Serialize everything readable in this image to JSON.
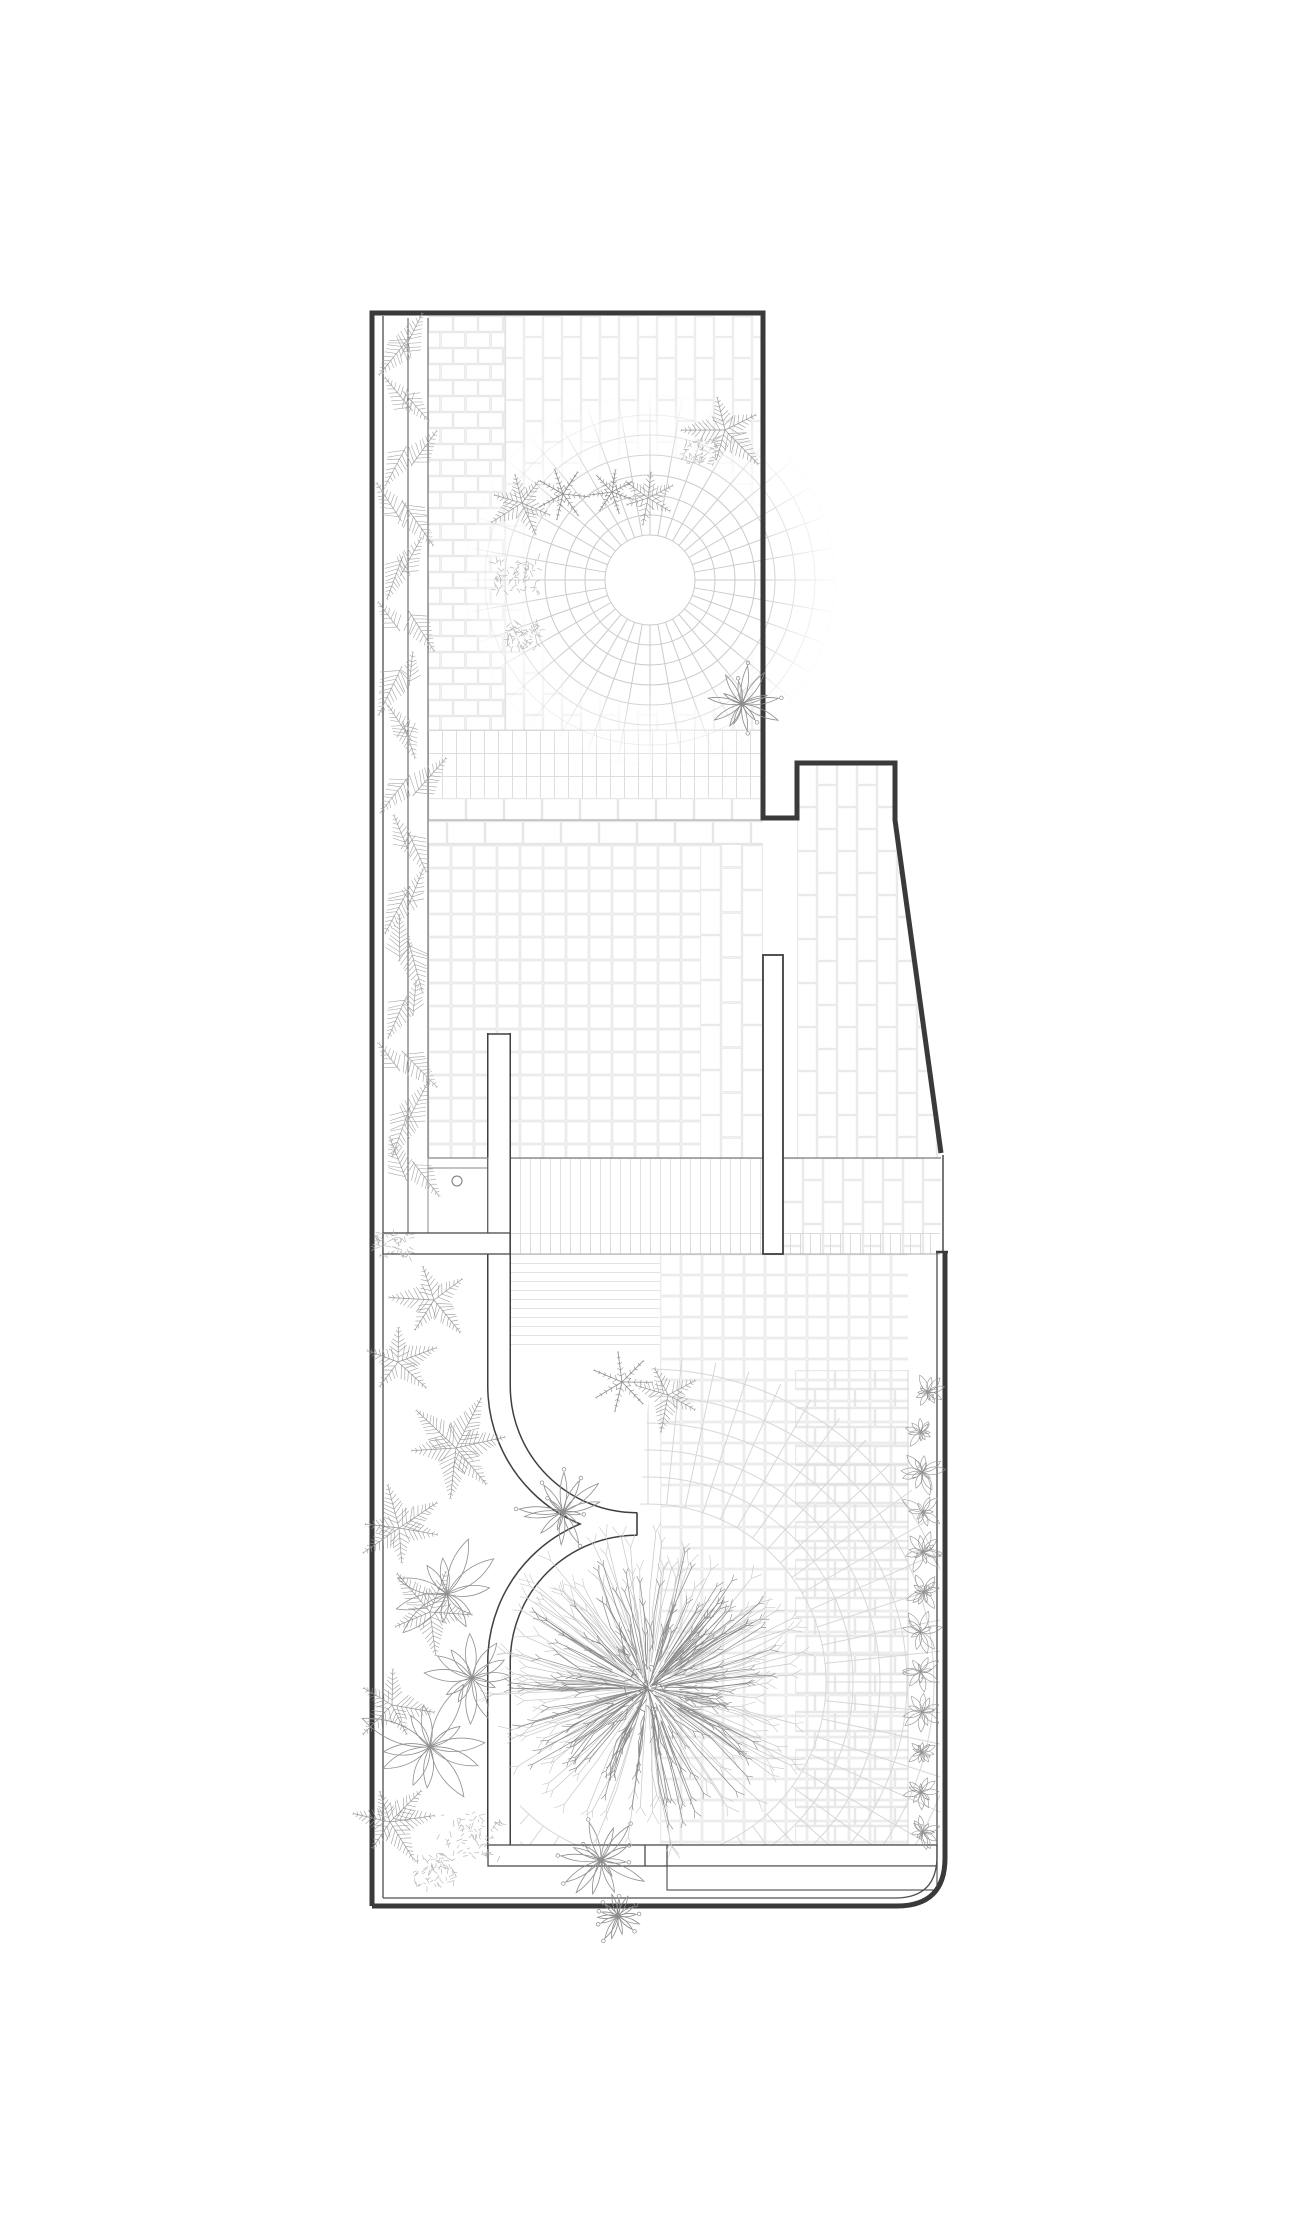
{
  "page": {
    "background": "#ffffff",
    "kind": "architectural-site-plan",
    "title": ""
  },
  "colors": {
    "boundary": "#3a3a3a",
    "line_dark": "#4a4a4a",
    "line_mid": "#7c7c7c",
    "tile": "#e3e3e3",
    "radial": "#cbcbcb",
    "fan": "#d7d7d7",
    "plant": "#969696",
    "plant_light": "#b0b0b0",
    "tree_outer": "#c6c6c6",
    "tree_inner": "#878787",
    "white": "#ffffff"
  },
  "plan": {
    "viewbox": [
      0,
      0,
      1300,
      2228
    ],
    "tile_regions": [
      {
        "n": "top-left-bricks",
        "r": [
          428,
          316,
          77,
          414
        ],
        "p": "hbrick",
        "tw": 25,
        "th": 16,
        "c": "#e2e2e2"
      },
      {
        "n": "top-main-bricks",
        "r": [
          505,
          316,
          258,
          414
        ],
        "p": "vbrick",
        "tw": 19,
        "th": 42,
        "c": "#e7e7e7"
      },
      {
        "n": "top-strip-band",
        "r": [
          428,
          730,
          335,
          68
        ],
        "p": "vstrip",
        "tw": 14,
        "th": 23,
        "c": "#dedede"
      },
      {
        "n": "top-hbrick-band",
        "r": [
          428,
          798,
          335,
          47
        ],
        "p": "hbrick",
        "tw": 38,
        "th": 23,
        "c": "#dedede"
      },
      {
        "n": "mid-grid",
        "r": [
          428,
          845,
          272,
          313
        ],
        "p": "square",
        "tw": 23,
        "th": 23,
        "c": "#e0e0e0"
      },
      {
        "n": "mid-right-bricks",
        "r": [
          700,
          845,
          63,
          313
        ],
        "p": "vbrick",
        "tw": 21,
        "th": 45,
        "c": "#e3e3e3"
      },
      {
        "n": "right-court-bricks",
        "poly": [
          [
            797,
            763
          ],
          [
            895,
            763
          ],
          [
            895,
            820
          ],
          [
            941,
            1158
          ],
          [
            797,
            1158
          ]
        ],
        "p": "vbrick",
        "tw": 20,
        "th": 44,
        "c": "#e3e3e3"
      },
      {
        "n": "mid-dense-band",
        "r": [
          510,
          1158,
          253,
          75
        ],
        "p": "vstrip",
        "tw": 10,
        "th": 75,
        "c": "#e1e1e1"
      },
      {
        "n": "right-band-bricks",
        "r": [
          783,
          1158,
          158,
          96
        ],
        "p": "vbrick",
        "tw": 20,
        "th": 44,
        "c": "#e3e3e3"
      },
      {
        "n": "bottom-dense-band",
        "r": [
          510,
          1233,
          430,
          21
        ],
        "p": "vstrip",
        "tw": 10,
        "th": 21,
        "c": "#dcdcdc"
      },
      {
        "n": "bottom-lined",
        "r": [
          510,
          1254,
          150,
          92
        ],
        "p": "hstrip",
        "tw": 150,
        "th": 9,
        "c": "#e3e3e3"
      },
      {
        "n": "bottom-grid",
        "r": [
          660,
          1254,
          248,
          591
        ],
        "p": "square",
        "tw": 21,
        "th": 21,
        "c": "#e1e1e1"
      },
      {
        "n": "bottom-right-bricks",
        "r": [
          795,
          1370,
          113,
          475
        ],
        "p": "hbrick",
        "tw": 40,
        "th": 19,
        "c": "#e1e1e1"
      }
    ],
    "lines": [
      [
        383,
        316,
        383,
        1898,
        1.3,
        "#4f4f4f"
      ],
      [
        408,
        318,
        408,
        1233,
        1.0,
        "#565656"
      ],
      [
        428,
        318,
        428,
        1233,
        1.0,
        "#565656"
      ],
      [
        505,
        316,
        505,
        730,
        1.0,
        "#dddddd"
      ],
      [
        428,
        730,
        763,
        730,
        0.8,
        "#d0d0d0"
      ],
      [
        428,
        820,
        763,
        820,
        1.0,
        "#9b9b9b"
      ],
      [
        428,
        1158,
        941,
        1158,
        1.2,
        "#7c7c7c"
      ],
      [
        510,
        1254,
        940,
        1254,
        1.0,
        "#ababab"
      ],
      [
        943,
        1155,
        943,
        1252,
        1.5,
        "#4a4a4a"
      ],
      [
        428,
        1168,
        488,
        1168,
        1.0,
        "#8a8a8a"
      ],
      [
        908,
        1370,
        908,
        1845,
        0.8,
        "#cccccc"
      ]
    ],
    "divider_lines": [
      [
        645,
        1845,
        645,
        1866,
        1.3,
        "#4a4a4a"
      ],
      [
        667,
        1845,
        667,
        1866,
        1.3,
        "#4a4a4a"
      ]
    ],
    "top_circle": {
      "cx": 650,
      "cy": 580,
      "r_white": 45,
      "rings": [
        45,
        65,
        85,
        105,
        125,
        145,
        165,
        185
      ],
      "spokes": 36,
      "r_back": 190
    },
    "fan": {
      "cx": 648,
      "cy": 1682,
      "rings": [
        178,
        205,
        232,
        259,
        286,
        313
      ],
      "spokes": 60,
      "r0": 178,
      "r1": 326,
      "clip": [
        [
          520,
          1706
        ],
        [
          639,
          1520
        ],
        [
          660,
          1254
        ],
        [
          940,
          1254
        ],
        [
          940,
          1845
        ],
        [
          520,
          1845
        ]
      ]
    },
    "ribbon": {
      "path_upper": "M499,1033 L499,1386 A138,138 0 0 0 637,1524",
      "path_lower": "M637,1524 A138,138 0 0 0 499,1662 L499,1849",
      "w_outer": 24,
      "w_inner": 21,
      "caps": [
        [
          637,
          1512.5,
          637,
          1535.5
        ],
        [
          487.5,
          1034,
          510.5,
          1034
        ]
      ]
    },
    "white_shapes": [
      {
        "n": "column-room",
        "r": [
          428,
          1158,
          60,
          75
        ],
        "f": "none",
        "s": "#8a8a8a",
        "sw": 1.0
      },
      {
        "n": "left-connector-band",
        "r": [
          383,
          1233,
          127,
          21
        ],
        "f": "#ffffff",
        "s": "#4a4a4a",
        "sw": 1.3
      },
      {
        "n": "freestanding-wall",
        "r": [
          763,
          955,
          20,
          299
        ],
        "f": "#ffffff",
        "s": "#3f3f3f",
        "sw": 1.8
      },
      {
        "n": "step-band-a",
        "r": [
          488,
          1845,
          449,
          21
        ],
        "f": "#ffffff",
        "s": "#4a4a4a",
        "sw": 1.3
      },
      {
        "n": "step-band-b",
        "r": [
          667,
          1866,
          270,
          24
        ],
        "f": "#ffffff",
        "s": "#4a4a4a",
        "sw": 1.1
      }
    ],
    "room_circle": {
      "cx": 457,
      "cy": 1181,
      "r": 5,
      "s": "#777777"
    },
    "boundary": {
      "outer": [
        "M372,1906 L372,313 L763,313 L763,818 L797,818 L797,763 L895,763 L895,820 L941,1153",
        "M945,1252 L945,1858 Q945,1906 897,1906 L372,1906"
      ],
      "outer_width": 5,
      "cap": [
        936,
        1252,
        948,
        1252
      ],
      "inner": "M937,1252 L937,1856 Q937,1898 895,1898 L383,1898",
      "inner_width": 1.3
    },
    "hedge": {
      "x": 406,
      "y0": 336,
      "y1": 1212,
      "step": 55,
      "len": 46
    },
    "shrub_row": {
      "x": 924,
      "y0": 1392,
      "y1": 1832,
      "step": 40
    },
    "plants": [
      {
        "t": "fern",
        "x": 522,
        "y": 503,
        "s": 0.85,
        "r": 200
      },
      {
        "t": "snow",
        "x": 563,
        "y": 494,
        "s": 1.0,
        "r": 0
      },
      {
        "t": "snow",
        "x": 612,
        "y": 492,
        "s": 0.85,
        "r": 20
      },
      {
        "t": "fern",
        "x": 648,
        "y": 498,
        "s": 0.6,
        "r": -20
      },
      {
        "t": "fuzzy",
        "x": 517,
        "y": 575,
        "s": 1.0,
        "r": 0
      },
      {
        "t": "fuzzy",
        "x": 523,
        "y": 635,
        "s": 0.75,
        "r": 0
      },
      {
        "t": "fern",
        "x": 725,
        "y": 430,
        "s": 1.0,
        "r": -95
      },
      {
        "t": "fuzzy",
        "x": 700,
        "y": 452,
        "s": 0.8,
        "r": 0
      },
      {
        "t": "flower",
        "x": 742,
        "y": 704,
        "s": 1.05,
        "r": 0
      },
      {
        "t": "snow",
        "x": 622,
        "y": 1382,
        "s": 1.15,
        "r": 0
      },
      {
        "t": "fern",
        "x": 668,
        "y": 1395,
        "s": 0.8,
        "r": 40
      },
      {
        "t": "flower",
        "x": 563,
        "y": 1512,
        "s": 0.95,
        "r": 10
      },
      {
        "t": "fern",
        "x": 434,
        "y": 1300,
        "s": 1.05,
        "r": -30
      },
      {
        "t": "fern",
        "x": 398,
        "y": 1362,
        "s": 0.95,
        "r": 50
      },
      {
        "t": "fern",
        "x": 456,
        "y": 1448,
        "s": 1.15,
        "r": -10
      },
      {
        "t": "fern",
        "x": 399,
        "y": 1528,
        "s": 1.0,
        "r": 80
      },
      {
        "t": "fern",
        "x": 430,
        "y": 1612,
        "s": 1.05,
        "r": -60
      },
      {
        "t": "lily",
        "x": 447,
        "y": 1594,
        "s": 1.0,
        "r": 0
      },
      {
        "t": "lily",
        "x": 472,
        "y": 1678,
        "s": 0.8,
        "r": 30
      },
      {
        "t": "lily",
        "x": 430,
        "y": 1747,
        "s": 1.2,
        "r": 60
      },
      {
        "t": "fern",
        "x": 392,
        "y": 1705,
        "s": 0.9,
        "r": 140
      },
      {
        "t": "fern",
        "x": 390,
        "y": 1822,
        "s": 0.95,
        "r": -120
      },
      {
        "t": "fuzzy",
        "x": 470,
        "y": 1836,
        "s": 1.4,
        "r": 0
      },
      {
        "t": "fuzzy",
        "x": 435,
        "y": 1872,
        "s": 0.9,
        "r": 0
      },
      {
        "t": "flower",
        "x": 601,
        "y": 1860,
        "s": 1.0,
        "r": 0
      },
      {
        "t": "flower",
        "x": 618,
        "y": 1916,
        "s": 0.55,
        "r": 45
      },
      {
        "t": "fuzzy",
        "x": 392,
        "y": 1246,
        "s": 0.8,
        "r": 0
      }
    ],
    "tree": {
      "cx": 648,
      "cy": 1688,
      "r_outer": 162,
      "r_inner": 142
    }
  }
}
